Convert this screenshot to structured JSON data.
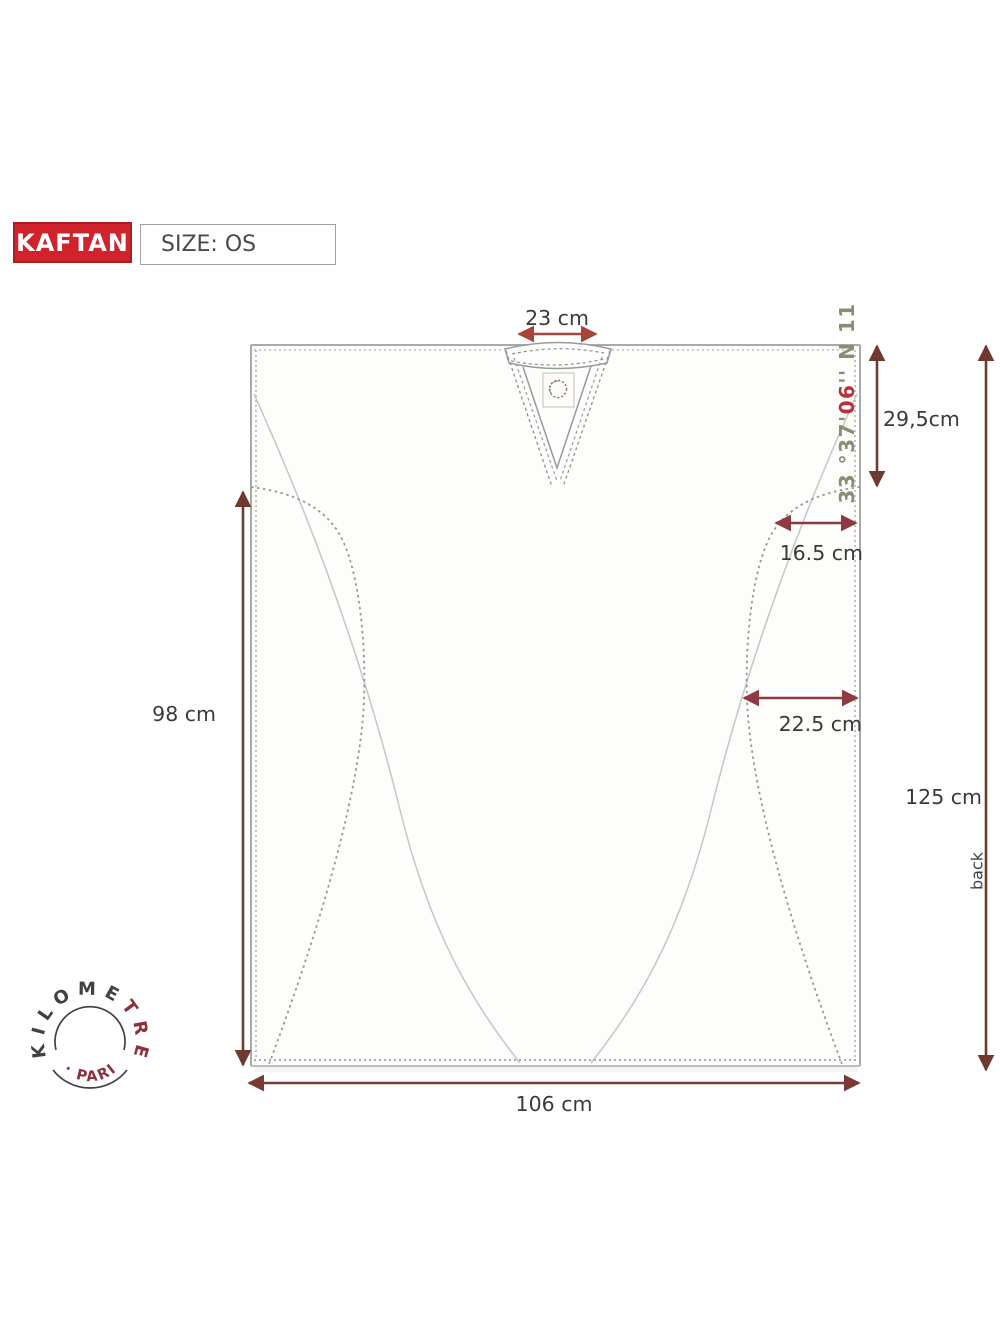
{
  "header": {
    "product_badge": "KAFTAN",
    "size_label": "SIZE: OS"
  },
  "measurements": {
    "neck_width": "23 cm",
    "neck_drop": "29,5cm",
    "armhole_top_inset": "16.5 cm",
    "armhole_bottom_inset": "22.5 cm",
    "side_seam": "98 cm",
    "center_back": "125 cm",
    "hem_width": "106 cm",
    "orientation": "back"
  },
  "garment_print": {
    "coord_prefix": "33 °37'",
    "coord_accent": "06",
    "coord_suffix": "'' N 11"
  },
  "brand_stamp": {
    "top_dark": "KILOME",
    "top_red": "TRE",
    "bottom_text": "· PARIS"
  },
  "colors": {
    "badge_red": "#d0232b",
    "arrow_dark": "#6f392f",
    "arrow_bright": "#a8433a",
    "arrow_rose": "#8d3b41",
    "arrow_mid": "#7a3a34",
    "coord_olive": "#8c8c74",
    "coord_red": "#b5323c",
    "stamp_dark": "#43413f",
    "stamp_red": "#8e2f3a",
    "outline_gray": "#a9a9a9"
  }
}
